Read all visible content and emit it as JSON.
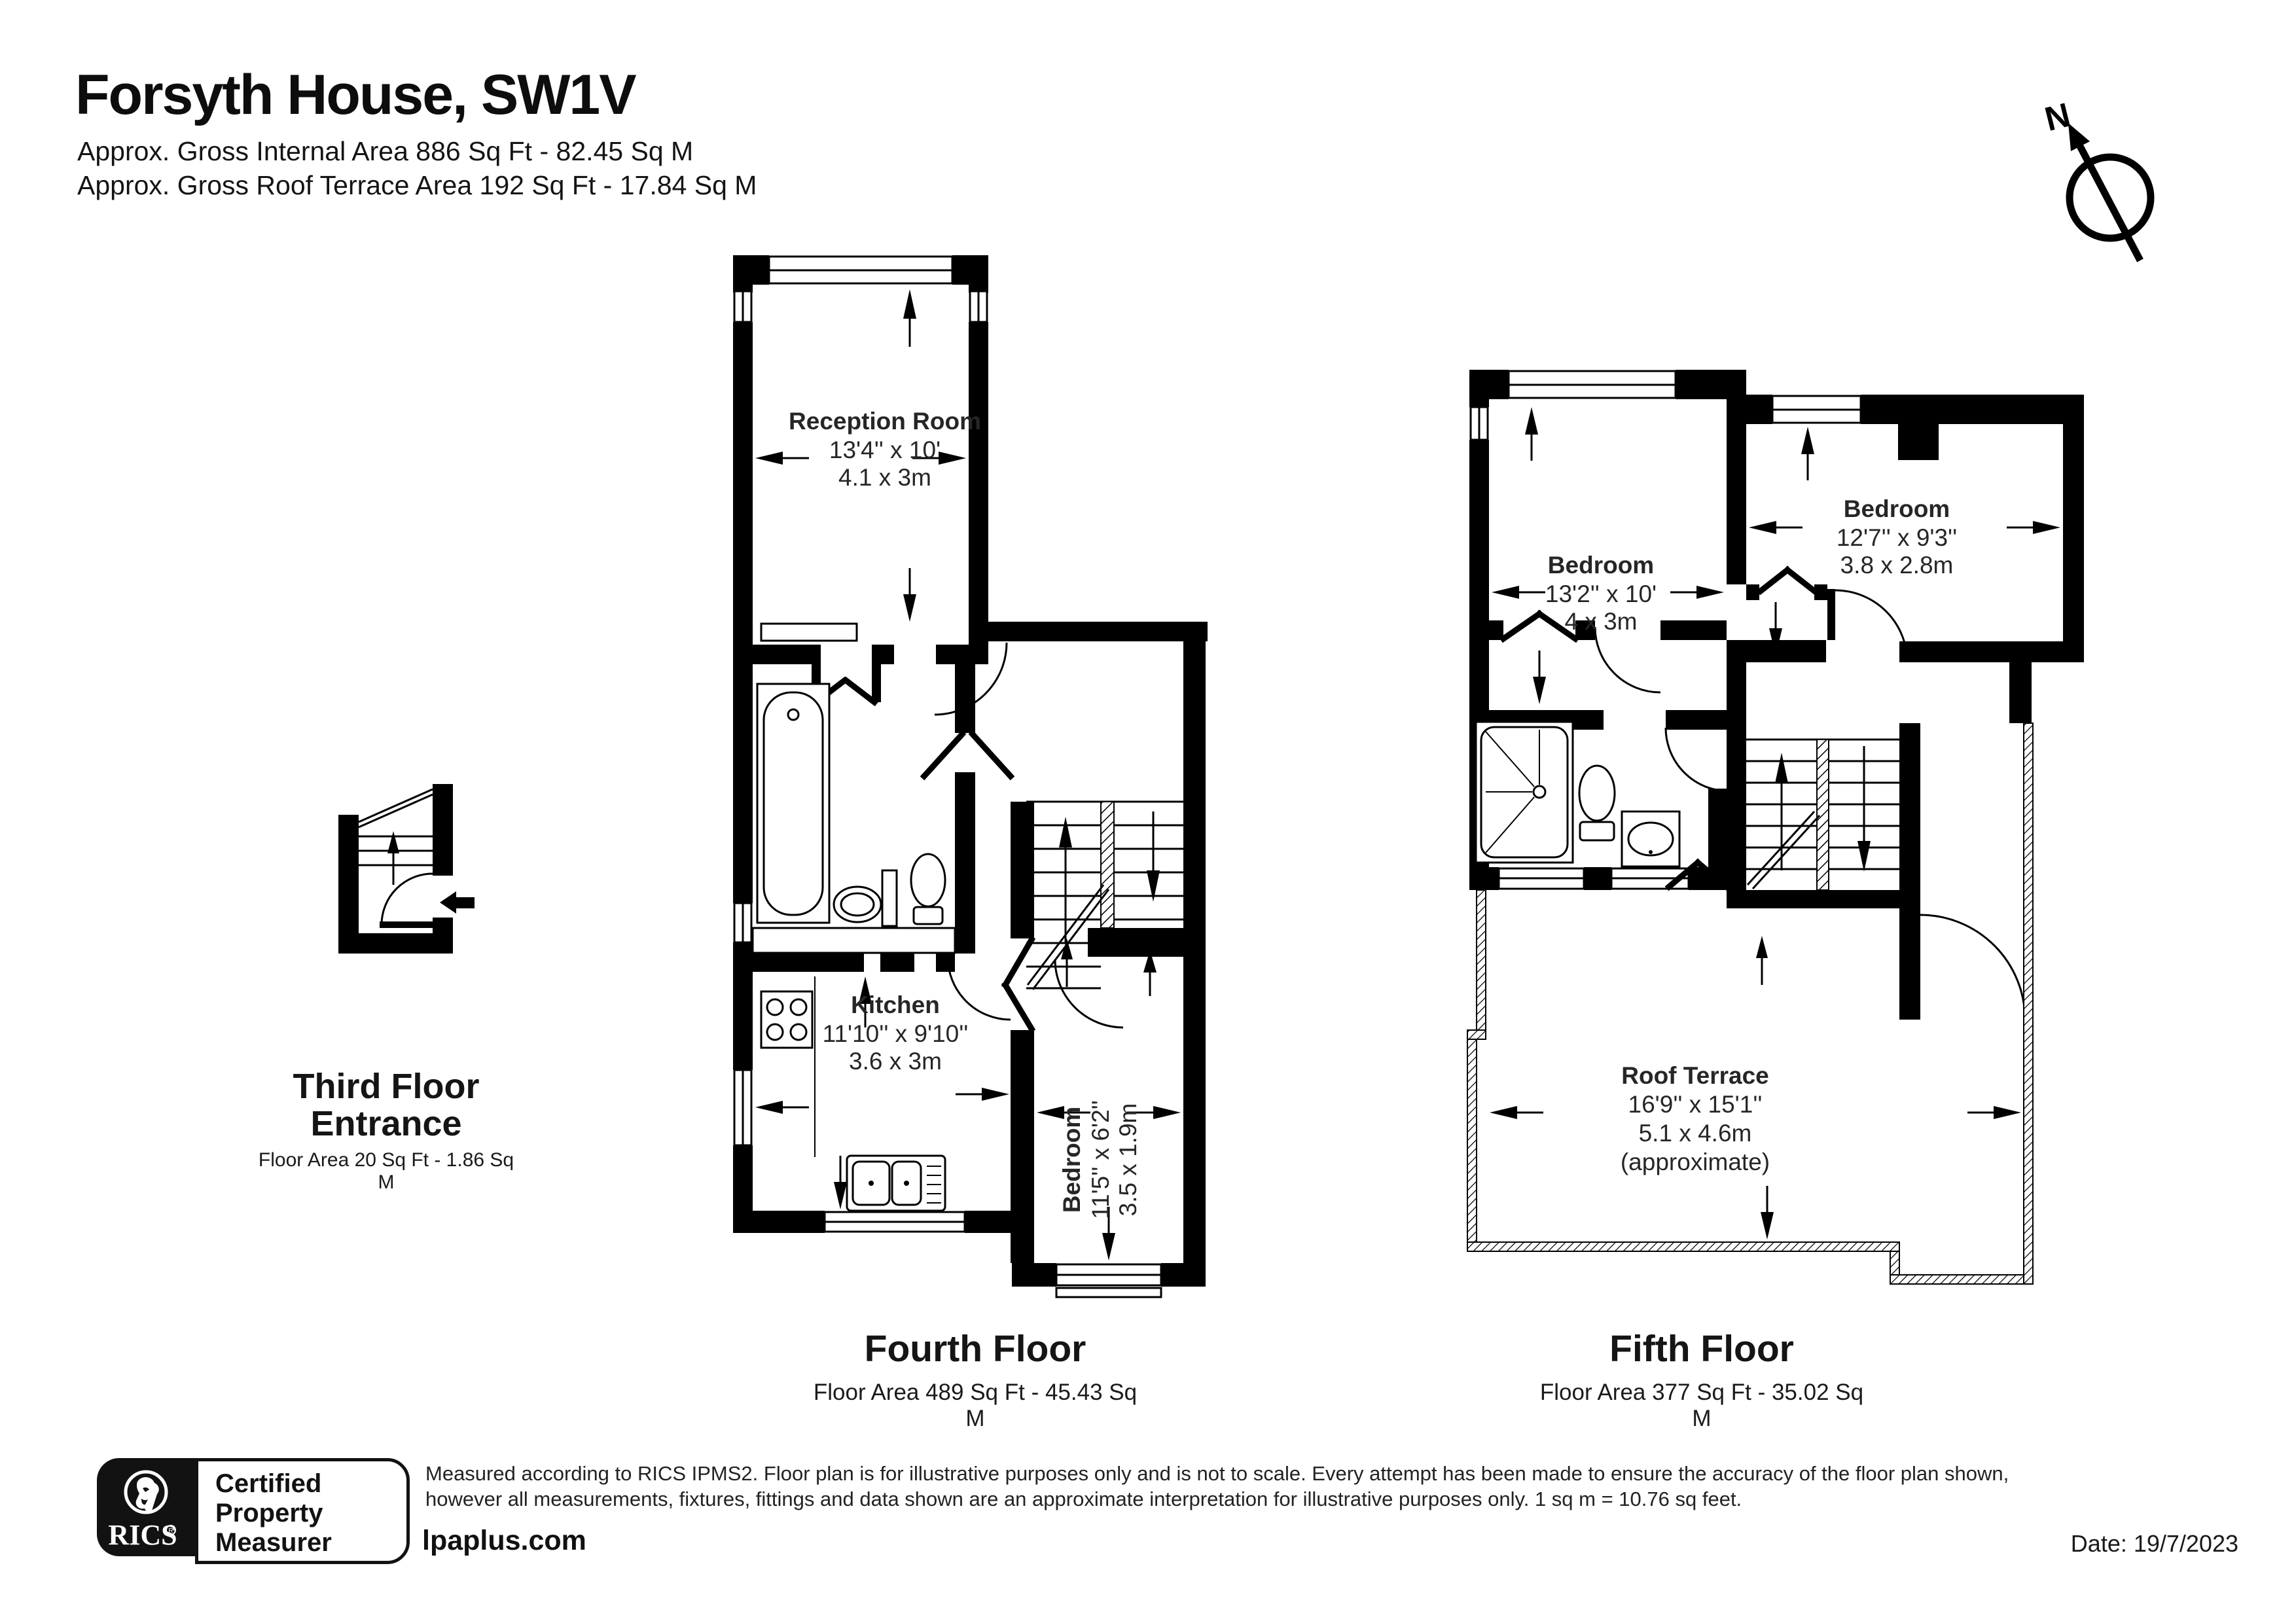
{
  "header": {
    "title": "Forsyth House, SW1V",
    "subtitle1": "Approx. Gross Internal Area 886 Sq Ft - 82.45 Sq M",
    "subtitle2": "Approx. Gross Roof Terrace Area 192 Sq Ft - 17.84 Sq M"
  },
  "compass": {
    "label": "N"
  },
  "floors": {
    "third": {
      "title_line1": "Third Floor",
      "title_line2": "Entrance",
      "area": "Floor Area 20 Sq Ft - 1.86 Sq M"
    },
    "fourth": {
      "title": "Fourth Floor",
      "area": "Floor Area 489 Sq Ft - 45.43 Sq M",
      "rooms": {
        "reception": {
          "name": "Reception Room",
          "imperial": "13'4'' x 10'",
          "metric": "4.1 x 3m"
        },
        "kitchen": {
          "name": "Kitchen",
          "imperial": "11'10'' x 9'10''",
          "metric": "3.6 x 3m"
        },
        "bedroom": {
          "name": "Bedroom",
          "imperial": "11'5'' x 6'2''",
          "metric": "3.5 x 1.9m"
        }
      }
    },
    "fifth": {
      "title": "Fifth Floor",
      "area": "Floor Area 377 Sq Ft - 35.02 Sq M",
      "rooms": {
        "bedroom_left": {
          "name": "Bedroom",
          "imperial": "13'2'' x 10'",
          "metric": "4 x 3m"
        },
        "bedroom_right": {
          "name": "Bedroom",
          "imperial": "12'7'' x 9'3''",
          "metric": "3.8 x 2.8m"
        },
        "roof_terrace": {
          "name": "Roof Terrace",
          "imperial": "16'9'' x 15'1''",
          "metric": "5.1 x 4.6m",
          "note": "(approximate)"
        }
      }
    }
  },
  "footer": {
    "rics": "RICS",
    "badge": {
      "line1": "Certified",
      "line2": "Property",
      "line3": "Measurer"
    },
    "disclaimer_line1": "Measured according to RICS IPMS2. Floor plan is for illustrative purposes only and is not to scale. Every attempt has been made to ensure the accuracy of the floor plan shown,",
    "disclaimer_line2": "however all measurements, fixtures, fittings and data shown are an approximate interpretation for illustrative purposes only. 1 sq m = 10.76 sq feet.",
    "website": "lpaplus.com",
    "date": "Date: 19/7/2023"
  },
  "colors": {
    "ink": "#000000",
    "label_text": "#262626",
    "paper": "#ffffff"
  }
}
